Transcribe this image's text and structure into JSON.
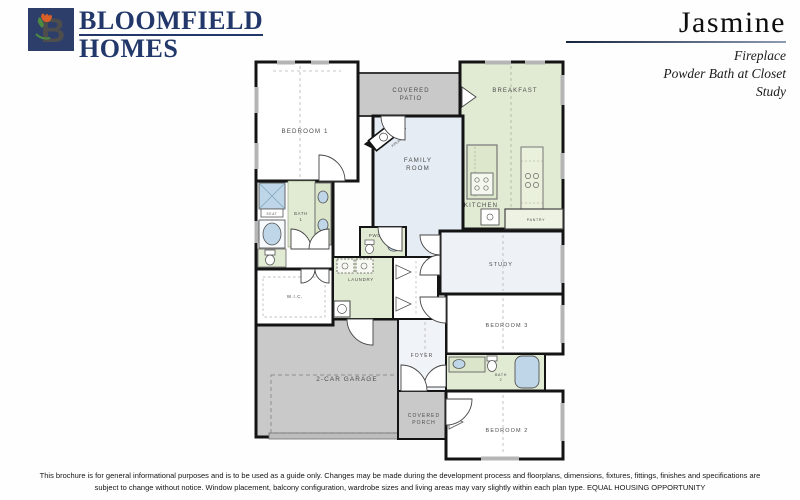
{
  "header": {
    "logo": {
      "monogram": "B",
      "icon": "tulip-b-monogram-icon",
      "name_line1": "BLOOMFIELD",
      "name_line2": "HOMES"
    },
    "plan_name": "Jasmine",
    "options": [
      "Fireplace",
      "Powder Bath at Closet",
      "Study"
    ]
  },
  "floorplan": {
    "labels": {
      "bedroom1": "BEDROOM 1",
      "covered_patio": [
        "COVERED",
        "PATIO"
      ],
      "breakfast": "BREAKFAST",
      "family_room": [
        "FAMILY",
        "ROOM"
      ],
      "kitchen": "KITCHEN",
      "pantry": "PANTRY",
      "bath1": [
        "BATH",
        "1"
      ],
      "seat": "SEAT",
      "powder": "PWDR",
      "laundry": "LAUNDRY",
      "wic": "W.I.C.",
      "garage": "2-CAR GARAGE",
      "foyer": "FOYER",
      "covered_porch": [
        "COVERED",
        "PORCH"
      ],
      "study": "STUDY",
      "bedroom3": "BEDROOM 3",
      "bath2": [
        "BATH",
        "2"
      ],
      "bedroom2": "BEDROOM 2",
      "fireplace": "F/PLACE"
    }
  },
  "footer": {
    "disclaimer_line1": "This brochure is for general informational purposes and is to be used as a guide only. Changes may be made during the development process and floorplans, dimensions, fixtures, fittings, finishes and specifications are",
    "disclaimer_line2": "subject to change without notice. Window placement, balcony configuration, wardrobe sizes and living areas may vary slightly within each plan type.  EQUAL HOUSING OPPORTUNITY"
  },
  "colors": {
    "brand_navy": "#23386a",
    "logo_green": "#5a9e4d",
    "logo_tulip": "#d95f27",
    "room_green": "#e1ead3",
    "room_blue": "#e5ecf3",
    "room_lightblue": "#eef2f7",
    "concrete_gray": "#c9c9c9",
    "fixture_blue": "#bed6e7",
    "wall_black": "#141414"
  }
}
